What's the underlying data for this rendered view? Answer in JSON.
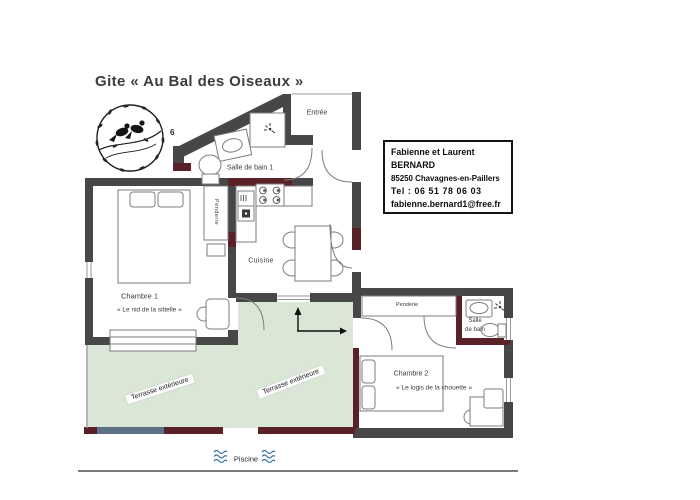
{
  "title": "Gite « Au Bal des Oiseaux »",
  "contact_card": {
    "line1": "Fabienne et Laurent",
    "line2": "BERNARD",
    "line3": "85250 Chavagnes-en-Paillers",
    "line4": "Tel : 06 51 78 06 03",
    "line5": "fabienne.bernard1@free.fr"
  },
  "labels": {
    "entree": "Entrée",
    "salle_de_bain_1": "Salle de bain 1",
    "penderie_1": "Penderie",
    "cuisine": "Cuisine",
    "chambre_1": "Chambre 1",
    "chambre_1_name": "« Le nid de la sittelle »",
    "terrasse_left": "Terrasse extérieure",
    "terrasse_right": "Terrasse extérieure",
    "penderie_2": "Penderie",
    "salle_de_bain_2_line1": "Salle",
    "salle_de_bain_2_line2": "de bain",
    "chambre_2": "Chambre 2",
    "chambre_2_name": "« Le logis de la chouette »",
    "piscine": "Piscine",
    "corner_mark": "6"
  },
  "colors": {
    "wall": "#474747",
    "wall_accent": "#5a2128",
    "wall_blue": "#5d7186",
    "terrace_green": "#dbe7d6",
    "water_blue": "#3a6fa6"
  }
}
